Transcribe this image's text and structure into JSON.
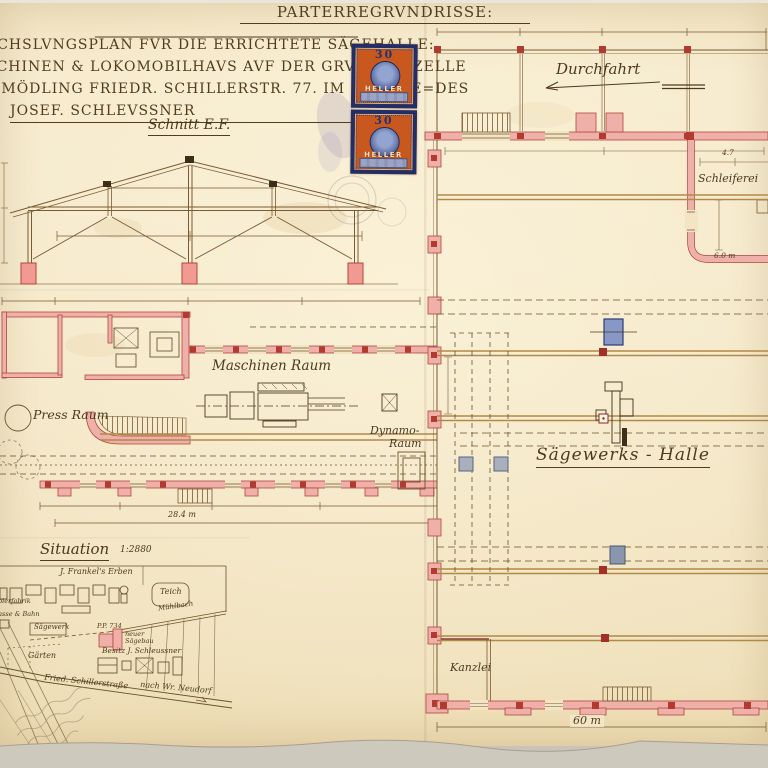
{
  "page_title": "PARTERREGRVNDRISSE:",
  "header": {
    "line1": "ECHSLVNGSPLAN FVR DIE ERRICHTETE SÄGEHALLE:",
    "line2": "SCHINEN & LOKOMOBILHAVS AVF DER GRVNDPARZELLE",
    "line3": "2 MÖDLING FRIEDR. SCHILLERSTR. 77. IM BESITZE=DES",
    "line4": "JOSEF. SCHLEVSSNER"
  },
  "stamps": {
    "value": "30",
    "currency": "HELLER"
  },
  "section": {
    "label": "Schnitt E.F."
  },
  "plan": {
    "durchfahrt": "Durchfahrt",
    "schleiferei": "Schleiferei",
    "maschinen_raum": "Maschinen Raum",
    "press_raum": "Press Raum",
    "dynamo_line1": "Dynamo-",
    "dynamo_line2": "Raum",
    "saegewerk_halle": "Sägewerks - Halle",
    "kanzlei": "Kanzlei"
  },
  "dimensions": {
    "hall_width": "60 m",
    "machine_house_width": "28.4 m",
    "schleiferei_width": "4.7",
    "schleiferei_depth": "6.0 m"
  },
  "situation": {
    "title": "Situation",
    "scale": "1:2880",
    "frankel": "J. Frankel's Erben",
    "teich": "Teich",
    "muehlbach": "Mühlbach",
    "saegewerk": "Sägewerk",
    "parcel": "P.P. 734",
    "neuer_saegebau_1": "neuer",
    "neuer_saegebau_2": "Sägebau",
    "besitz": "Besitz J. Schleussner",
    "gaerten": "Gärten",
    "strasse": "Fried. Schillerstraße",
    "nach": "nach Wr. Neudorf",
    "papierfabrik": "Papierfabrik",
    "bahn": "Strasse & Bahn"
  },
  "colors": {
    "paper": "#f3e5c4",
    "ink": "#4c3a20",
    "wall_pink": "#f0b0aa",
    "wall_edge": "#b0463c",
    "pier_red": "#b13b30",
    "rail_tan": "#b08a48",
    "foundation_blue": "#8898c6",
    "stamp_orange": "#c8581e",
    "stamp_navy": "#232e66"
  }
}
